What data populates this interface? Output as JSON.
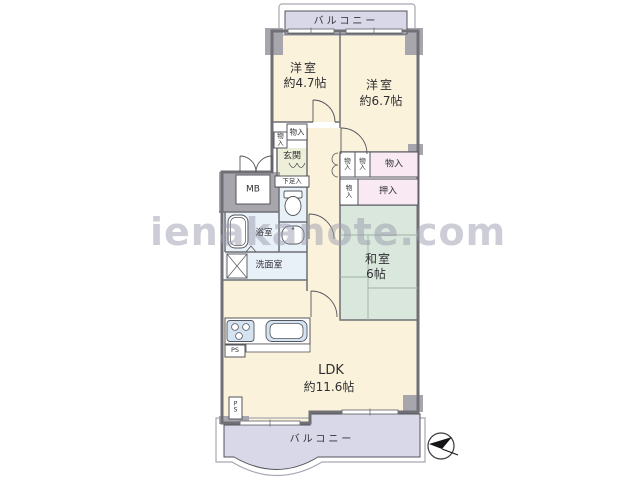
{
  "watermark": {
    "text": "ienakanote.com"
  },
  "rooms": {
    "balcony_top": {
      "label": "バルコニー"
    },
    "bedroom_small": {
      "label": "洋室",
      "size": "約4.7帖"
    },
    "bedroom_large": {
      "label": "洋室",
      "size": "約6.7帖"
    },
    "entrance": {
      "label": "玄関"
    },
    "shoe_cabinet": {
      "label": "下足入"
    },
    "meter_box": {
      "label": "MB"
    },
    "bathroom": {
      "label": "浴室"
    },
    "washroom": {
      "label": "洗面室"
    },
    "closet_top_left": {
      "label": "物入"
    },
    "closet_top": {
      "label": "物入"
    },
    "closet_hall_a": {
      "label": "物入"
    },
    "closet_hall_b": {
      "label": "物入"
    },
    "closet_wide": {
      "label": "物入"
    },
    "closet_mid": {
      "label": "物入"
    },
    "oshiire": {
      "label": "押入"
    },
    "japanese_room": {
      "label": "和室",
      "size": "6帖"
    },
    "ldk": {
      "label": "LDK",
      "size": "約11.6帖"
    },
    "pipe_space_kitchen": {
      "label": "PS"
    },
    "pipe_space_south": {
      "label": "PS"
    },
    "balcony_bottom": {
      "label": "バルコニー"
    }
  },
  "icons": {
    "compass": "north-arrow",
    "toilet": "toilet-bowl",
    "bathtub": "bathtub",
    "stove": "stove-burners",
    "sink": "kitchen-sink",
    "washing_machine": "washing-machine-cross"
  },
  "colors": {
    "room_floor": "#FBF2DB",
    "balcony": "#D8D8E9",
    "tatami": "#D9E7DC",
    "wet_area": "#E9F1F8",
    "fixture_blue": "#D4E3F2",
    "closet_pink": "#F8E9F2",
    "entrance_floor": "#EEEFD8",
    "wall": "#6F6F75",
    "column_gray": "#A6A6AC"
  }
}
